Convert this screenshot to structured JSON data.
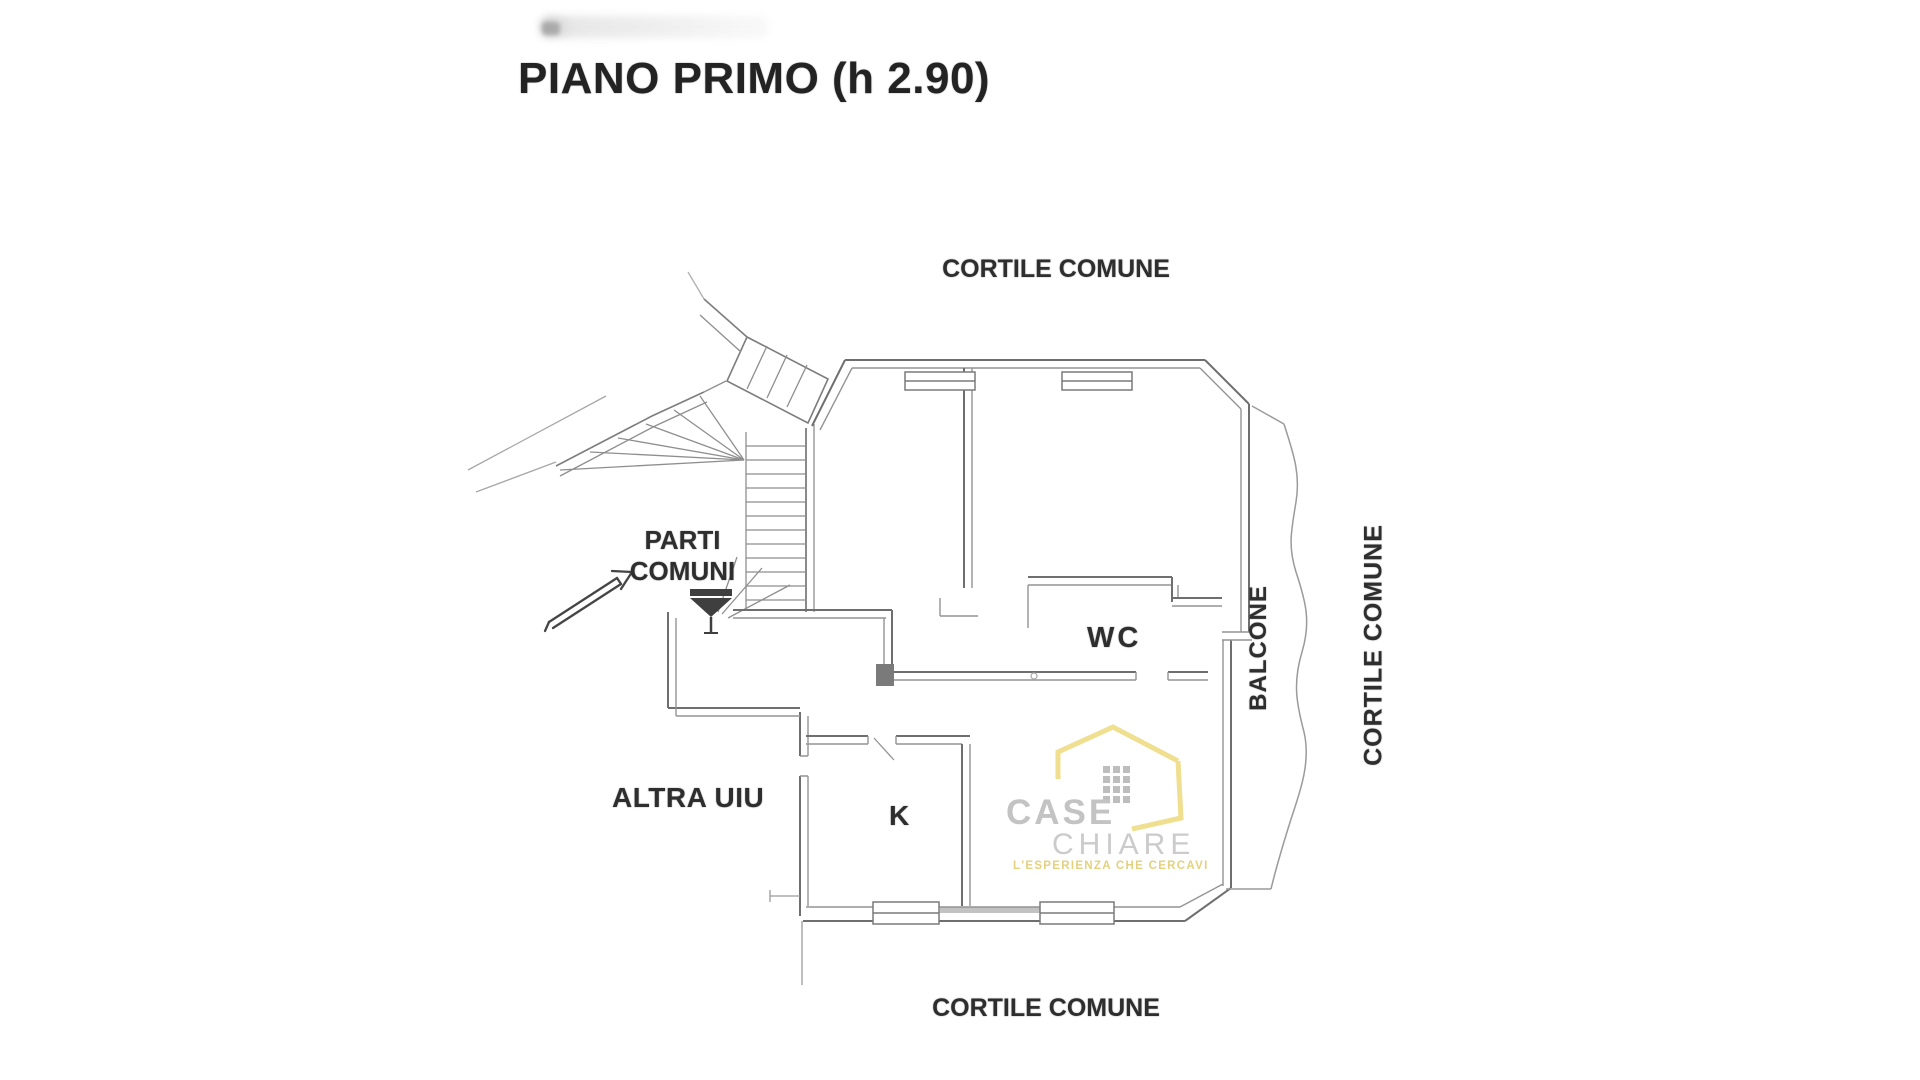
{
  "title": "PIANO PRIMO (h 2.90)",
  "labels": {
    "courtyard_top": "CORTILE COMUNE",
    "courtyard_bottom": "CORTILE COMUNE",
    "courtyard_right": "CORTILE COMUNE",
    "balcony": "BALCONE",
    "common_parts_line1": "PARTI",
    "common_parts_line2": "COMUNI",
    "other_unit": "ALTRA UIU",
    "wc": "WC",
    "kitchen": "K"
  },
  "watermark": {
    "brand_top": "CASE",
    "brand_bottom": "CHIARE",
    "tagline": "L'ESPERIENZA CHE CERCAVI",
    "house_color": "#f0df8e",
    "brand_gray": "#c3c3c3",
    "tagline_color": "#e4d17e"
  },
  "plan": {
    "wall_color": "#6f6f6f",
    "wall_inner_color": "#949494",
    "stair_color": "#8e8e8e",
    "faint_color": "#a8a8a8",
    "label_color": "#2e2e2e",
    "marker_color": "#3f3f3f"
  }
}
